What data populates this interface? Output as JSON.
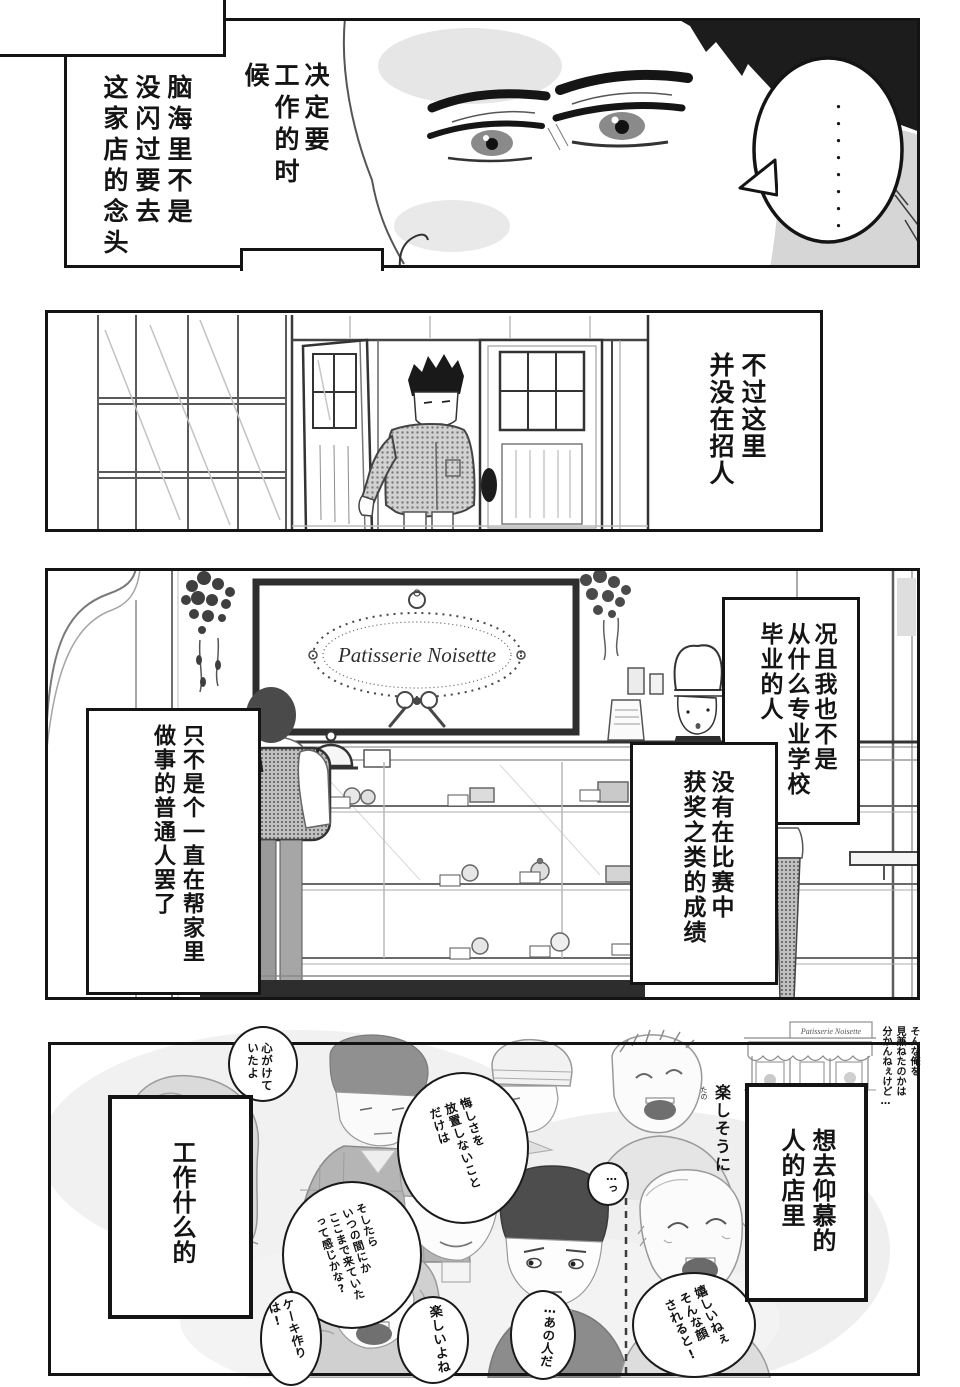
{
  "colors": {
    "ink": "#141414",
    "paper": "#ffffff",
    "halftone": "#bdbdbd",
    "sketch": "#8f8f8f"
  },
  "panel1": {
    "narration_right": "决定要\n工作的时候",
    "narration_left": "脑海里不是\n没闪过要去\n这家店的念头",
    "bubble_dots": "・・・・・・・・"
  },
  "panel2": {
    "narration": "不过这里\n并没在招人"
  },
  "panel3": {
    "sign_text": "Patisserie Noisette",
    "narration_right": "况且我也不是\n从什么专业学校\n毕业的人",
    "narration_mid": "没有在比赛中\n获奖之类的成绩",
    "narration_left": "只不是个一直在帮家里\n做事的普通人罢了"
  },
  "panel4": {
    "storefront_sign": "Patisserie Noisette",
    "aside_top_right": "そんな俺を\n見兼ねたのかは\n分かんねぇけど…",
    "aside_laughing": "楽しそうに",
    "furigana_fun": "たの",
    "bubble_mindful": "心がけて\nいたよ",
    "bubble_frustration": "悔しさを\n放置しないこと\nだけは",
    "bubble_before_knew": "そしたら\nいつの間にか\nここまで来ていた\nって感じかな?",
    "bubble_cake_making": "ケーキ作りは!",
    "bubble_fun": "楽しいよね",
    "bubble_that_person": "…あの人だ",
    "bubble_happy_face": "嬉しいねぇ\nそんな顔\nされると!",
    "bubble_tsu": "…っ",
    "narration_admire": "想去仰慕的\n人的店里",
    "narration_work": "工作什么的"
  }
}
